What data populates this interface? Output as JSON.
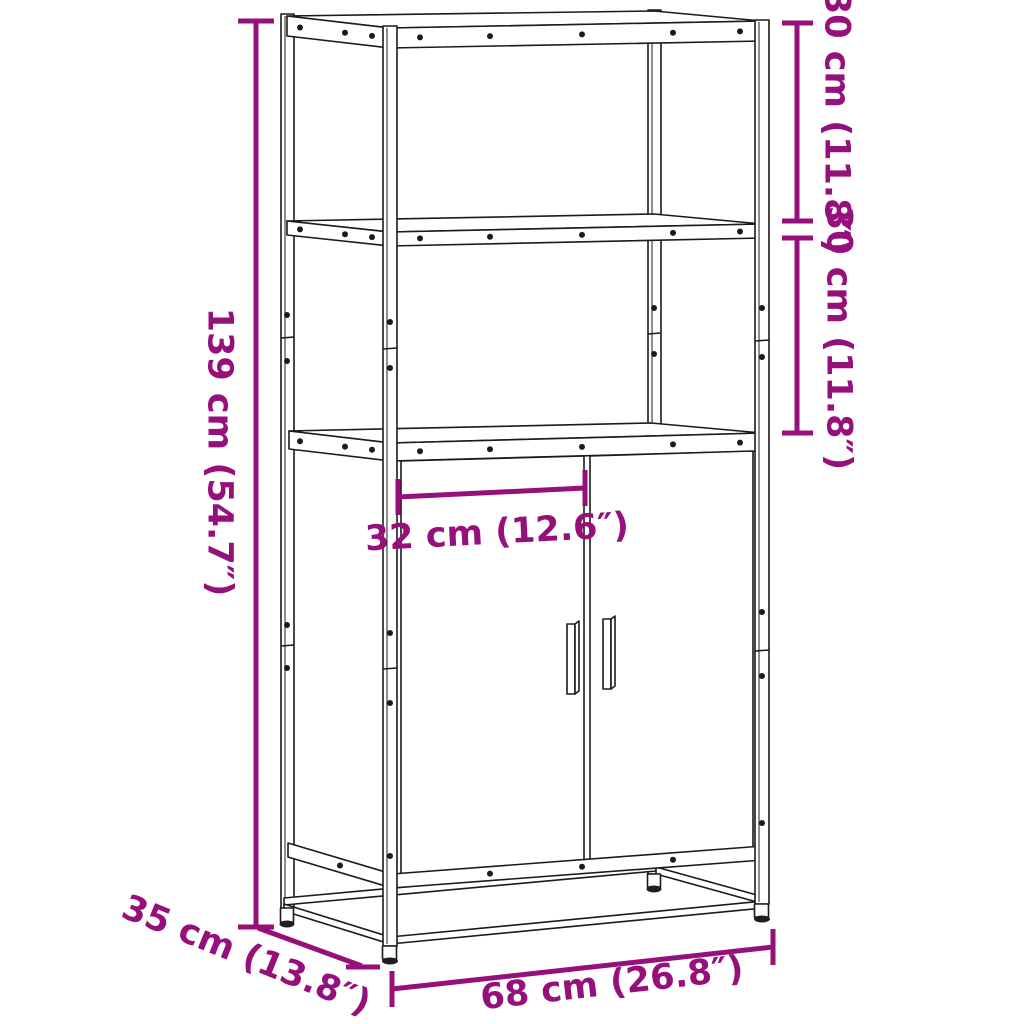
{
  "colors": {
    "dimension": "#96107C",
    "line_art": "#1b1b1b",
    "background": "#ffffff"
  },
  "dimensions": {
    "height": "139 cm (54.7″)",
    "top_shelf_height": "30 cm (11.8″)",
    "middle_shelf_height": "30 cm (11.8″)",
    "inner_width": "32 cm (12.6″)",
    "depth": "35 cm (13.8″)",
    "width": "68 cm (26.8″)"
  }
}
